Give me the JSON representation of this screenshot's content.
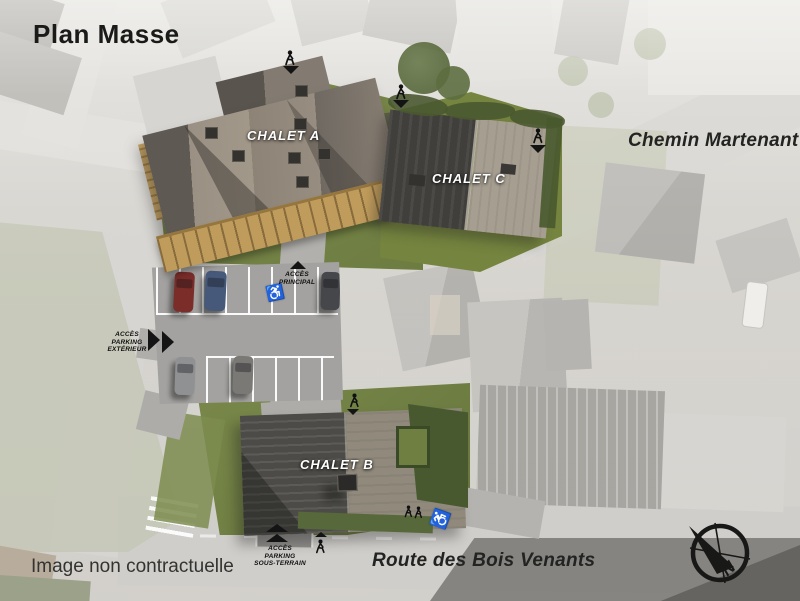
{
  "title": "Plan Masse",
  "disclaimer": "Image non contractuelle",
  "buildings": {
    "a": "CHALET A",
    "b": "CHALET B",
    "c": "CHALET C"
  },
  "roads": {
    "chemin_martenant": "Chemin Martenant",
    "route_des_bois_venants": "Route des Bois Venants"
  },
  "access": {
    "principal": [
      "ACCÈS",
      "PRINCIPAL"
    ],
    "parking_exterieur": [
      "ACCÈS",
      "PARKING",
      "EXTÉRIEUR"
    ],
    "parking_sous_terrain": [
      "ACCÈS",
      "PARKING",
      "SOUS-TERRAIN"
    ]
  },
  "compass": {
    "north": "N"
  },
  "symbols": {
    "handicap": "♿"
  },
  "colors": {
    "grass": "#75843f",
    "hedge": "#49592f",
    "roof_dark": "#4c4b47",
    "roof_light": "#9a9083",
    "wood_balcony": "#c09c5c",
    "asphalt": "#a3a2a0",
    "ink": "#1b1b19"
  }
}
